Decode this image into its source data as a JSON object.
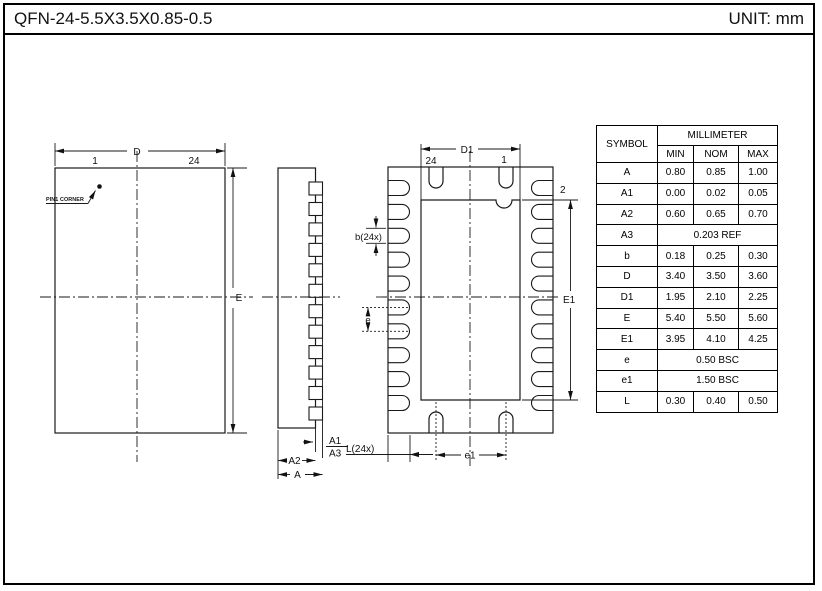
{
  "title_bar": {
    "title": "QFN-24-5.5X3.5X0.85-0.5",
    "unit": "UNIT: mm"
  },
  "drawing": {
    "top_view": {
      "dim_d": "D",
      "dim_e": "E",
      "pin_left": "1",
      "pin_right": "24",
      "pin1_corner": "PIN1 CORNER"
    },
    "side_view": {
      "dim_a": "A",
      "dim_a1": "A1",
      "dim_a2": "A2",
      "dim_a3": "A3"
    },
    "bottom_view": {
      "dim_d1": "D1",
      "dim_e1": "E1",
      "pin_left": "24",
      "pin_right": "1",
      "pin_2": "2",
      "dim_b": "b(24x)",
      "dim_e": "e",
      "dim_e1_bottom": "e1",
      "dim_l": "L(24x)"
    }
  },
  "table": {
    "header": {
      "symbol": "SYMBOL",
      "unit_group": "MILLIMETER",
      "min": "MIN",
      "nom": "NOM",
      "max": "MAX"
    },
    "rows": [
      {
        "symbol": "A",
        "min": "0.80",
        "nom": "0.85",
        "max": "1.00"
      },
      {
        "symbol": "A1",
        "min": "0.00",
        "nom": "0.02",
        "max": "0.05"
      },
      {
        "symbol": "A2",
        "min": "0.60",
        "nom": "0.65",
        "max": "0.70"
      },
      {
        "symbol": "A3",
        "span": "0.203 REF"
      },
      {
        "symbol": "b",
        "min": "0.18",
        "nom": "0.25",
        "max": "0.30"
      },
      {
        "symbol": "D",
        "min": "3.40",
        "nom": "3.50",
        "max": "3.60"
      },
      {
        "symbol": "D1",
        "min": "1.95",
        "nom": "2.10",
        "max": "2.25"
      },
      {
        "symbol": "E",
        "min": "5.40",
        "nom": "5.50",
        "max": "5.60"
      },
      {
        "symbol": "E1",
        "min": "3.95",
        "nom": "4.10",
        "max": "4.25"
      },
      {
        "symbol": "e",
        "span": "0.50 BSC"
      },
      {
        "symbol": "e1",
        "span": "1.50 BSC"
      },
      {
        "symbol": "L",
        "min": "0.30",
        "nom": "0.40",
        "max": "0.50"
      }
    ]
  },
  "colors": {
    "line": "#1a1a1a",
    "background": "#ffffff"
  }
}
